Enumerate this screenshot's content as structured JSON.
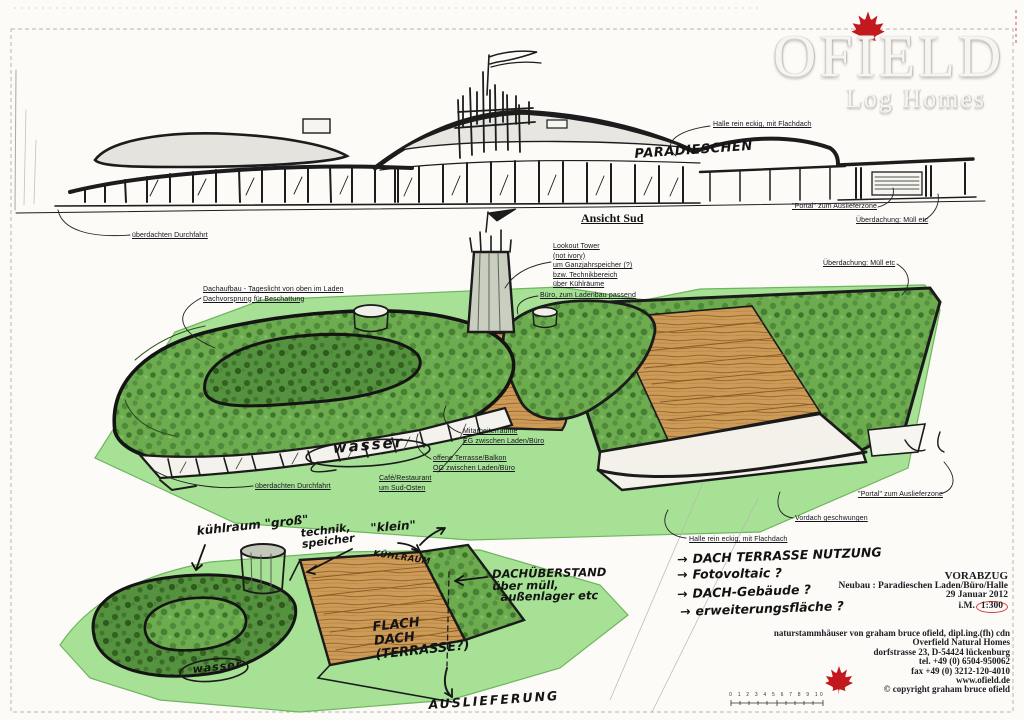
{
  "logo": {
    "title": "OFIELD",
    "subtitle": "Log Homes"
  },
  "elevation": {
    "view_title": "Ansicht Sud",
    "building_name": "PARADIESCHEN",
    "ann_halle": "Halle rein eckig, mit Flachdach",
    "ann_portal": "\"Portal\" zum Auslieferzone",
    "ann_ueberdachung": "Überdachung: Müll etc",
    "ann_durchfahrt": "überdachten Durchfahrt"
  },
  "perspective": {
    "lookout": [
      "Lookout Tower",
      "(not ivory)",
      "um Ganzjahrspeicher (?)",
      "bzw. Technikbereich",
      "über Kühlräume"
    ],
    "buero": "Büro, zum Ladenbau passend",
    "ueberdachung": "Überdachung: Müll etc",
    "dachaufbau_1": "Dachaufbau - Tageslicht von oben im Laden",
    "dachaufbau_2": "Dachvorsprung für Beschattung",
    "mitarbeiter_1": "Mitarbeiterräume",
    "mitarbeiter_2": "EG zwischen Laden/Büro",
    "terrasse_1": "offene Terrasse/Balkon",
    "terrasse_2": "OG zwischen Laden/Büro",
    "cafe_1": "Café/Restaurant",
    "cafe_2": "um Sud-Osten",
    "durchfahrt": "überdachten Durchfahrt",
    "portal": "\"Portal\" zum Auslieferzone",
    "vordach": "Vordach geschwungen",
    "halle": "Halle rein eckig, mit Flachdach",
    "wasser": "wasser"
  },
  "site_sketch": {
    "kuehlraum_gross": "kühlraum \"groß\"",
    "technik": "technik,",
    "speicher": "speicher",
    "klein": "\"klein\"",
    "kuehlraum_klein": "KÜHLRAUM",
    "dachueberstand_1": "DACHÜBERSTAND",
    "dachueberstand_2": "über müll,",
    "dachueberstand_3": "außenlager etc",
    "flachdach_1": "FLACH",
    "flachdach_2": "DACH",
    "flachdach_3": "(TERRASSE?)",
    "wasser": "wasser",
    "auslieferung": "AUSLIEFERUNG"
  },
  "notes": {
    "arrow": "→",
    "items": [
      "DACH TERRASSE NUTZUNG",
      "Fotovoltaic ?",
      "DACH-Gebäude ?",
      "erweiterungsfläche ?"
    ]
  },
  "title_block": {
    "status": "VORABZUG",
    "project": "Neubau : Paradieschen Laden/Büro/Halle",
    "date": "29 Januar 2012",
    "scale_prefix": "i.M.",
    "scale": "1:300"
  },
  "address_block": {
    "line1": "naturstammhäuser von graham bruce ofield, dipl.ing.(fh) cdn",
    "line2": "Overfield Natural Homes",
    "line3": "dorfstrasse 23, D-54424 lückenburg",
    "line4": "tel. +49 (0) 6504-950062",
    "line5": "fax +49 (0) 3212-120-4010",
    "line6": "www.ofield.de",
    "line7": "© copyright graham bruce ofield"
  },
  "scale_bar": {
    "ticks": "0 1 2 3 4 5 6 7 8 9 10"
  }
}
